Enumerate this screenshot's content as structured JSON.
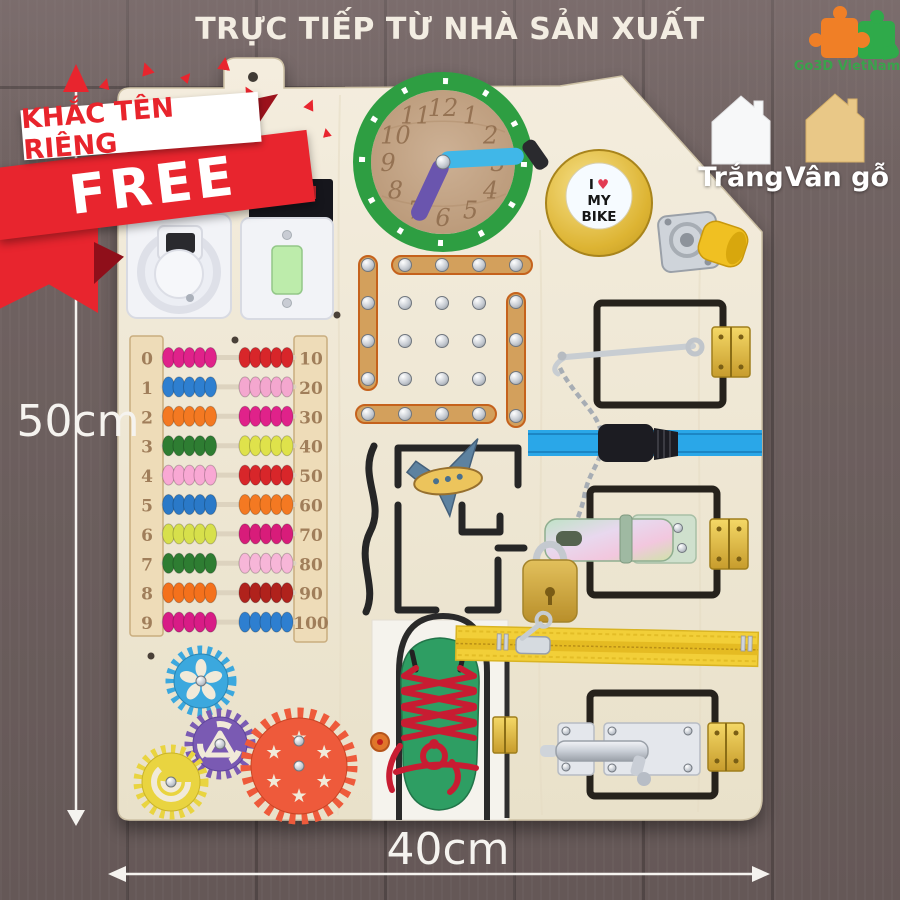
{
  "header": {
    "title": "TRỰC TIẾP TỪ NHÀ SẢN XUẤT"
  },
  "logo": {
    "text": "Go3D VietNam"
  },
  "ribbon": {
    "line1": "KHẮC TÊN RIÊNG",
    "line2": "FREE"
  },
  "swatches": {
    "white_label": "Trắng",
    "wood_label": "Vân gỗ"
  },
  "dimensions": {
    "height": "50cm",
    "width": "40cm"
  },
  "board": {
    "clock": {
      "numbers": [
        "12",
        "1",
        "2",
        "3",
        "4",
        "5",
        "6",
        "7",
        "8",
        "9",
        "10",
        "11"
      ]
    },
    "bell": {
      "word1": "I",
      "heart": "♥",
      "word2": "MY",
      "word3": "BIKE"
    },
    "abacus": {
      "rows": [
        {
          "left_label": "0",
          "right_label": "10",
          "left_color": "#e0218a",
          "right_color": "#d8262c"
        },
        {
          "left_label": "1",
          "right_label": "20",
          "left_color": "#2e7fd0",
          "right_color": "#f4a7cf"
        },
        {
          "left_label": "2",
          "right_label": "30",
          "left_color": "#f47920",
          "right_color": "#e0218a"
        },
        {
          "left_label": "3",
          "right_label": "40",
          "left_color": "#2e7d32",
          "right_color": "#dfe24b"
        },
        {
          "left_label": "4",
          "right_label": "50",
          "left_color": "#f9a8d4",
          "right_color": "#d8262c"
        },
        {
          "left_label": "5",
          "right_label": "60",
          "left_color": "#2979c8",
          "right_color": "#f47920"
        },
        {
          "left_label": "6",
          "right_label": "70",
          "left_color": "#d7e04b",
          "right_color": "#d81b7a"
        },
        {
          "left_label": "7",
          "right_label": "80",
          "left_color": "#2e7d32",
          "right_color": "#f7b6d8"
        },
        {
          "left_label": "8",
          "right_label": "90",
          "left_color": "#f4711f",
          "right_color": "#b0201f"
        },
        {
          "left_label": "9",
          "right_label": "100",
          "left_color": "#d81b86",
          "right_color": "#2e7fd0"
        }
      ]
    }
  },
  "colors": {
    "background_wood": "#6e6160",
    "board_plywood": "#f1ead9",
    "accent_red": "#e8252e",
    "clock_ring_green": "#2f9e43",
    "bell_gold": "#d9ab2d",
    "strap_blue": "#2ba7e8",
    "zipper_yellow": "#f2cf39",
    "shoe_green": "#2f9e63",
    "lace_red": "#c81f33",
    "gear_blue": "#3aa8de",
    "gear_purple": "#7a5ab3",
    "gear_yellow": "#e9d43f",
    "gear_red": "#ee5a3a",
    "logo_orange": "#f07f26",
    "logo_green": "#2faa4a"
  }
}
